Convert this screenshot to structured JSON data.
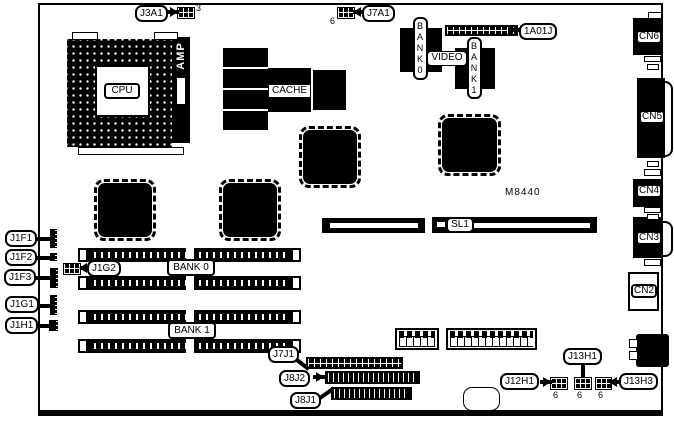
{
  "model": "M8440",
  "labels": {
    "cpu": "CPU",
    "amp": "AMP",
    "cache": "CACHE",
    "video": "VIDEO",
    "bank0_vertical": "BANK0",
    "bank1_vertical": "BANK1",
    "bank0": "BANK 0",
    "bank1": "BANK 1",
    "sl1": "SL1"
  },
  "callouts": {
    "j3a1": "J3A1",
    "j7a1": "J7A1",
    "a1a01j": "1A01J",
    "j1f1": "J1F1",
    "j1f2": "J1F2",
    "j1f3": "J1F3",
    "j1g1": "J1G1",
    "j1g2": "J1G2",
    "j1h1": "J1H1",
    "j7j1": "J7J1",
    "j8j2": "J8J2",
    "j8j1": "J8J1",
    "j12h1": "J12H1",
    "j13h1": "J13H1",
    "j13h3": "J13H3"
  },
  "rear_connectors": {
    "cn6": "CN6",
    "cn5": "CN5",
    "cn4": "CN4",
    "cn3": "CN3",
    "cn2": "CN2"
  },
  "pin_counts": {
    "j3a1": "3",
    "j7a1": "6",
    "j12h1": "6",
    "j13h1": "6",
    "j13h3": "6"
  },
  "colors": {
    "component": "#000000",
    "board": "#ffffff",
    "text": "#000000"
  }
}
